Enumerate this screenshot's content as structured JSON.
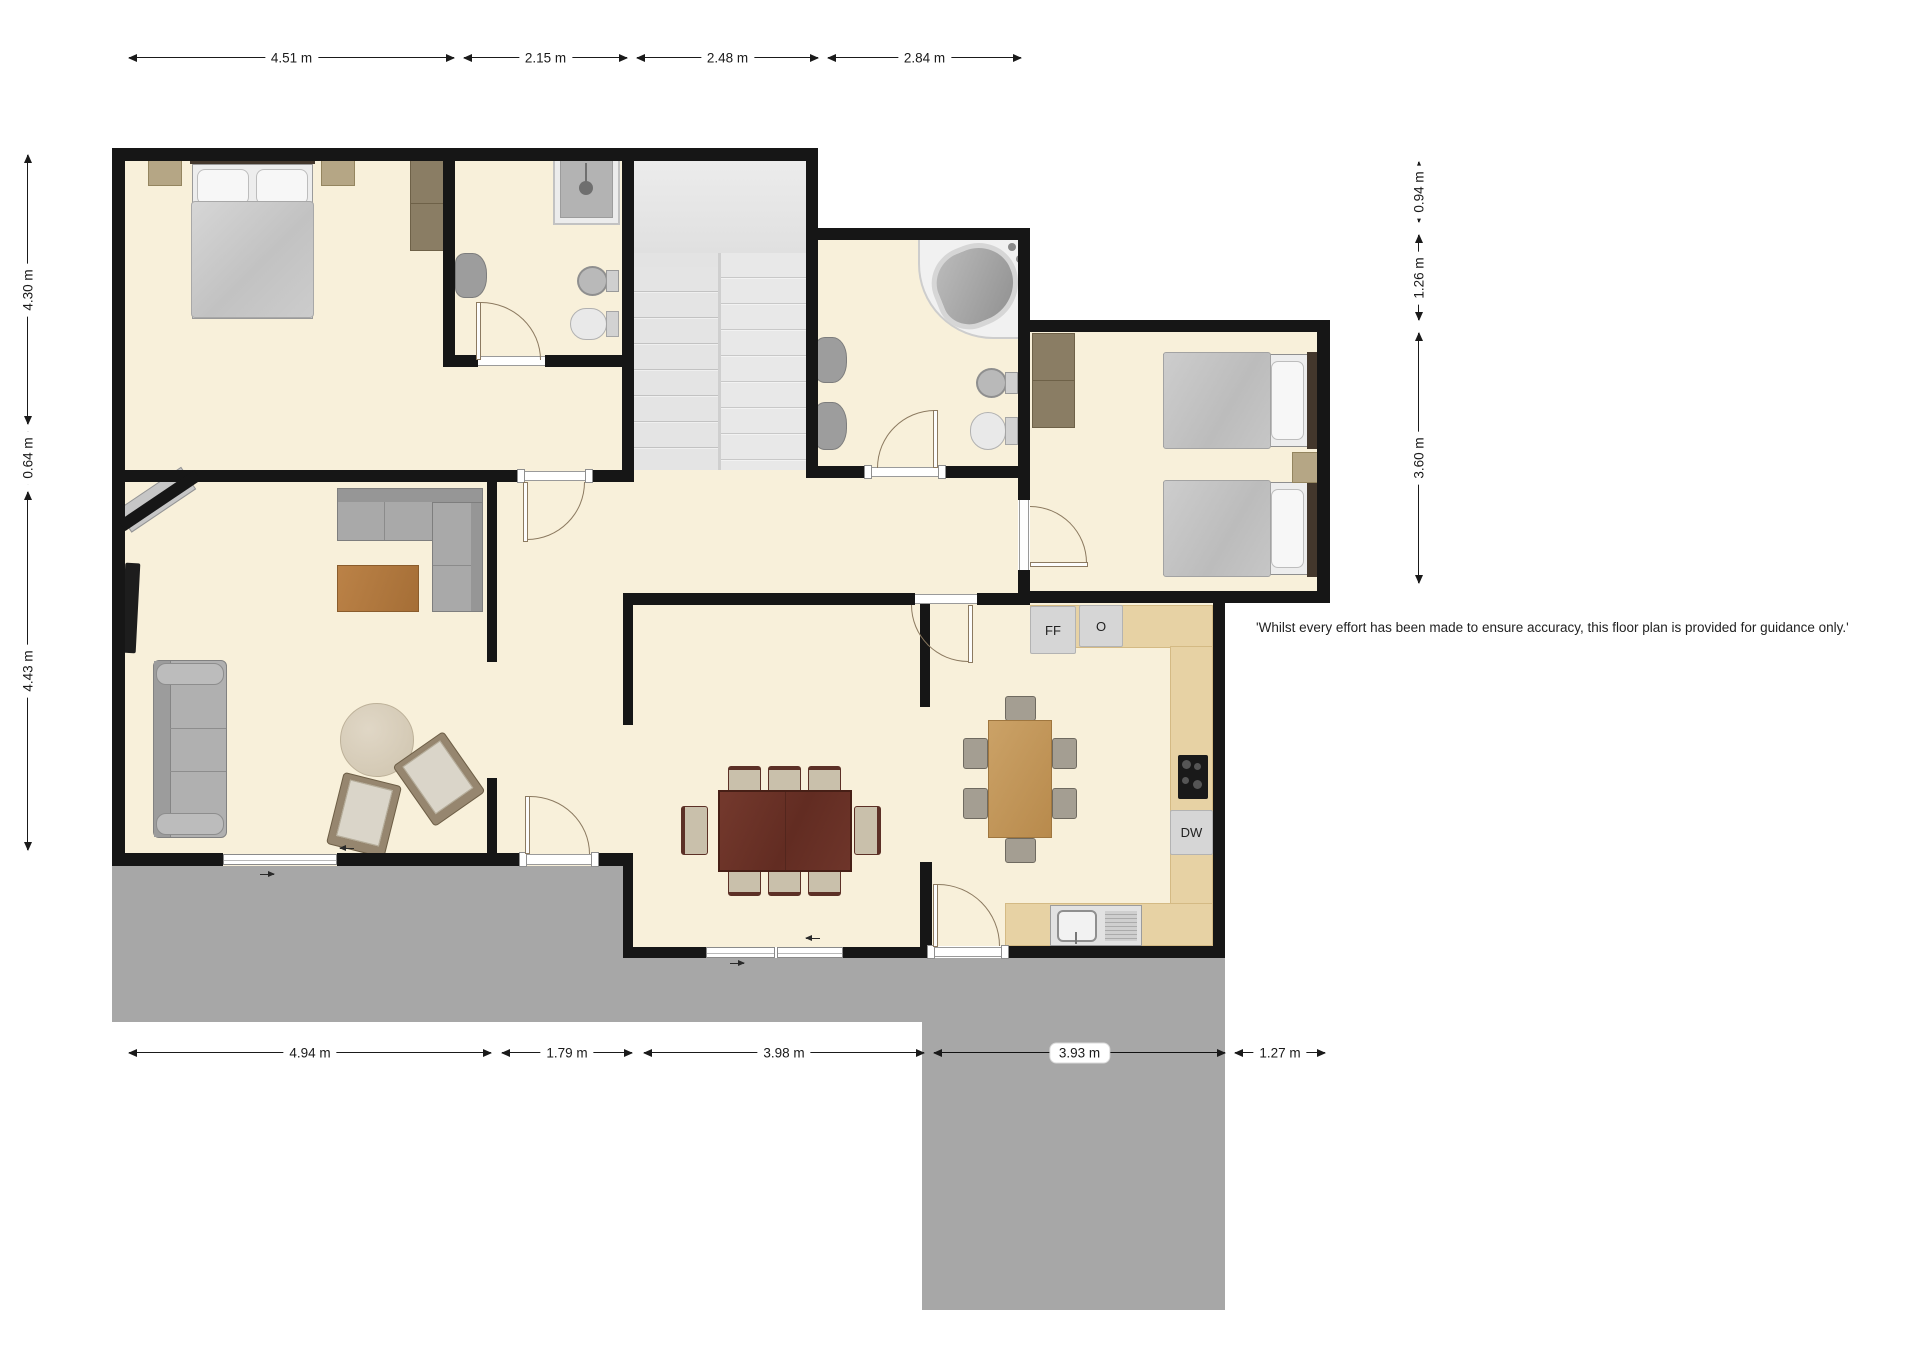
{
  "disclaimer": "'Whilst every effort has been made to ensure accuracy, this floor plan is provided for guidance only.'",
  "dimensions": {
    "top": [
      {
        "label": "4.51 m"
      },
      {
        "label": "2.15 m"
      },
      {
        "label": "2.48 m"
      },
      {
        "label": "2.84 m"
      }
    ],
    "bottom": [
      {
        "label": "4.94 m"
      },
      {
        "label": "1.79 m"
      },
      {
        "label": "3.98 m"
      },
      {
        "label": "3.93 m"
      },
      {
        "label": "1.27 m"
      }
    ],
    "left": [
      {
        "label": "4.30 m"
      },
      {
        "label": "0.64 m"
      },
      {
        "label": "4.43 m"
      }
    ],
    "right": [
      {
        "label": "0.94 m"
      },
      {
        "label": "1.26 m"
      },
      {
        "label": "3.60 m"
      }
    ]
  },
  "kitchen": {
    "fridge_freezer_label": "FF",
    "oven_label": "O",
    "dishwasher_label": "DW"
  },
  "colors": {
    "floor": "#f8f0da",
    "wall": "#161616",
    "patio": "#a7a7a7",
    "stairs": "#e3e3e3",
    "counter": "#e7d2a4",
    "dining_table": "#6c352a",
    "kitchen_table": "#c59a5f"
  }
}
